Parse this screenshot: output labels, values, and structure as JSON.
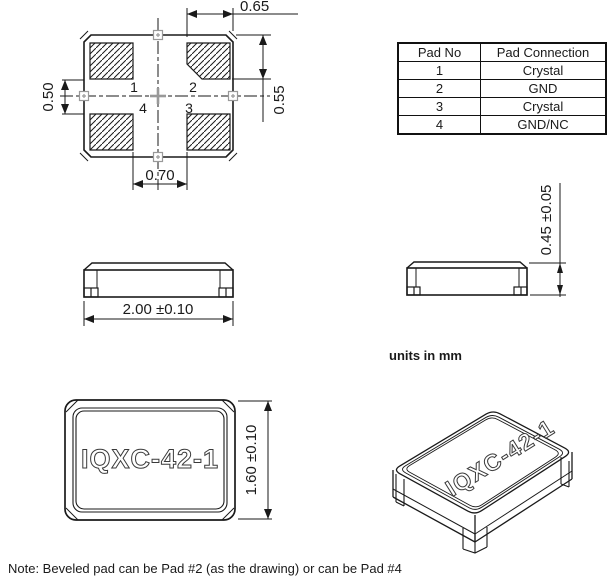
{
  "top_view": {
    "pad_labels": {
      "p1": "1",
      "p2": "2",
      "p3": "3",
      "p4": "4"
    },
    "dims": {
      "top": "0.65",
      "right": "0.55",
      "left": "0.50",
      "bottom": "0.70"
    }
  },
  "side_view_front": {
    "dim": "2.00 ±0.10"
  },
  "side_view_right": {
    "dim": "0.45 ±0.05"
  },
  "bottom_view": {
    "part_number": "IQXC-42-1",
    "dim": "1.60 ±0.10"
  },
  "iso_view": {
    "part_number": "IQXC-42-1"
  },
  "units_label": "units in mm",
  "note": "Note: Beveled pad can be Pad #2 (as the drawing) or can be Pad #4",
  "table": {
    "headers": [
      "Pad No",
      "Pad Connection"
    ],
    "rows": [
      [
        "1",
        "Crystal"
      ],
      [
        "2",
        "GND"
      ],
      [
        "3",
        "Crystal"
      ],
      [
        "4",
        "GND/NC"
      ]
    ]
  },
  "colors": {
    "line": "#1a1a1a",
    "gray_mark": "#999999"
  }
}
